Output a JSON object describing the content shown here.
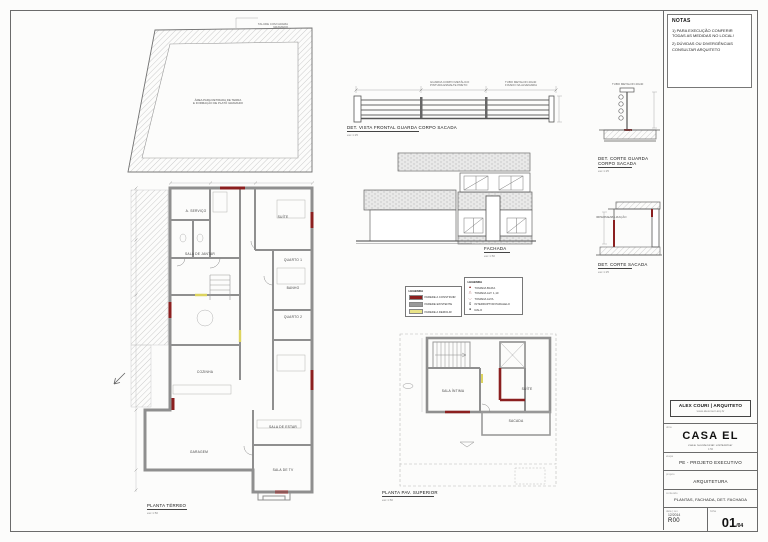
{
  "notes": {
    "title": "NOTAS",
    "l1": "1) PARA EXECUÇÃO CONFERIR TODAS AS MEDIDAS NO LOCAL!",
    "l2": "2) DÚVIDAS OU DIVERGÊNCIAS CONSULTAR ARQUITETO"
  },
  "titleblock": {
    "architect": "ALEX COURI | ARQUITETO",
    "website": "www.alexcouri.arq.br",
    "lbl_obra": "obra",
    "project": "CASA EL",
    "project_sub1": "casa residencial unifamiliar",
    "project_sub2": "1:50",
    "lbl_etapa": "etapa",
    "phase": "PE - PROJETO EXECUTIVO",
    "lbl_projeto": "projeto",
    "discipline": "ARQUITETURA",
    "lbl_conteudo": "conteúdo",
    "content": "PLANTAS, FACHADA, DET. FACHADA",
    "lbl_data": "data | rev.",
    "date": "12/2014",
    "revision": "R00",
    "lbl_folha": "folha",
    "sheet_no": "01",
    "sheet_suffix": "/04"
  },
  "titles": {
    "det_vista": {
      "t": "DET. VISTA FRONTAL GUARDA CORPO SACADA",
      "s": "esc 1:25"
    },
    "fachada": {
      "t": "FACHADA",
      "s": "esc 1:50"
    },
    "det_corte_gc": {
      "t": "DET. CORTE GUARDA CORPO SACADA",
      "s": "esc 1:25"
    },
    "det_corte_sacada": {
      "t": "DET. CORTE SACADA",
      "s": "esc 1:25"
    },
    "planta_terreo": {
      "t": "PLANTA TÉRREO",
      "s": "esc 1:50"
    },
    "planta_superior": {
      "t": "PLANTA PAV. SUPERIOR",
      "s": "esc 1:50"
    }
  },
  "site": {
    "talude1": "TALUDE COM GRAMA",
    "talude2": "GRAMADO",
    "note1": "ÁREA PARA RETIRADA DE TERRA",
    "note2": "E FORMAÇÃO DE PLATÔ GRAMADO"
  },
  "legend_walls": {
    "title": "LEGENDA",
    "items": [
      {
        "label": "PAREDE A CONSTRUIR",
        "color": "#8b1f1f"
      },
      {
        "label": "PAREDE EXISTENTE",
        "color": "#9a9a9a"
      },
      {
        "label": "PAREDE A DEMOLIR",
        "color": "#e9e388"
      }
    ]
  },
  "legend_symbols": {
    "title": "LEGENDA",
    "items": [
      {
        "label": "TOMADA BAIXA"
      },
      {
        "label": "TOMADA ALT. 1,10"
      },
      {
        "label": "TOMADA ALTA"
      },
      {
        "label": "INTERRUPTOR PARALELO"
      },
      {
        "label": "RALO"
      }
    ]
  },
  "rooms_terreo": {
    "servico": "A. SERVIÇO",
    "suite": "SUÍTE",
    "sala_jantar": "SALA DE JANTAR",
    "quarto1": "QUARTO 1",
    "banho": "BANHO",
    "quarto2": "QUARTO 2",
    "cozinha": "COZINHA",
    "garagem": "GARAGEM",
    "sala_estar": "SALA DE ESTAR",
    "sala_tv": "SALA DE TV"
  },
  "rooms_superior": {
    "sala_intima": "SALA ÍNTIMA",
    "suite": "SUÍTE",
    "sacada": "SACADA"
  },
  "annotations": {
    "railing_note1a": "GUARDA CORPO METÁLICO",
    "railing_note1b": "PINTURA ESMALTE PRETO",
    "railing_note2a": "TUBO METALON 40x40",
    "railing_note2b": "FIXADO NA ALVENARIA",
    "det_gc_note": "TUBO METALON 40x40",
    "det_sacada_note": "IMPERMEABILIZAÇÃO"
  },
  "colors": {
    "wall_new": "#8b1f1f",
    "wall_existing": "#9a9a9a",
    "wall_demolish": "#e9e388"
  }
}
